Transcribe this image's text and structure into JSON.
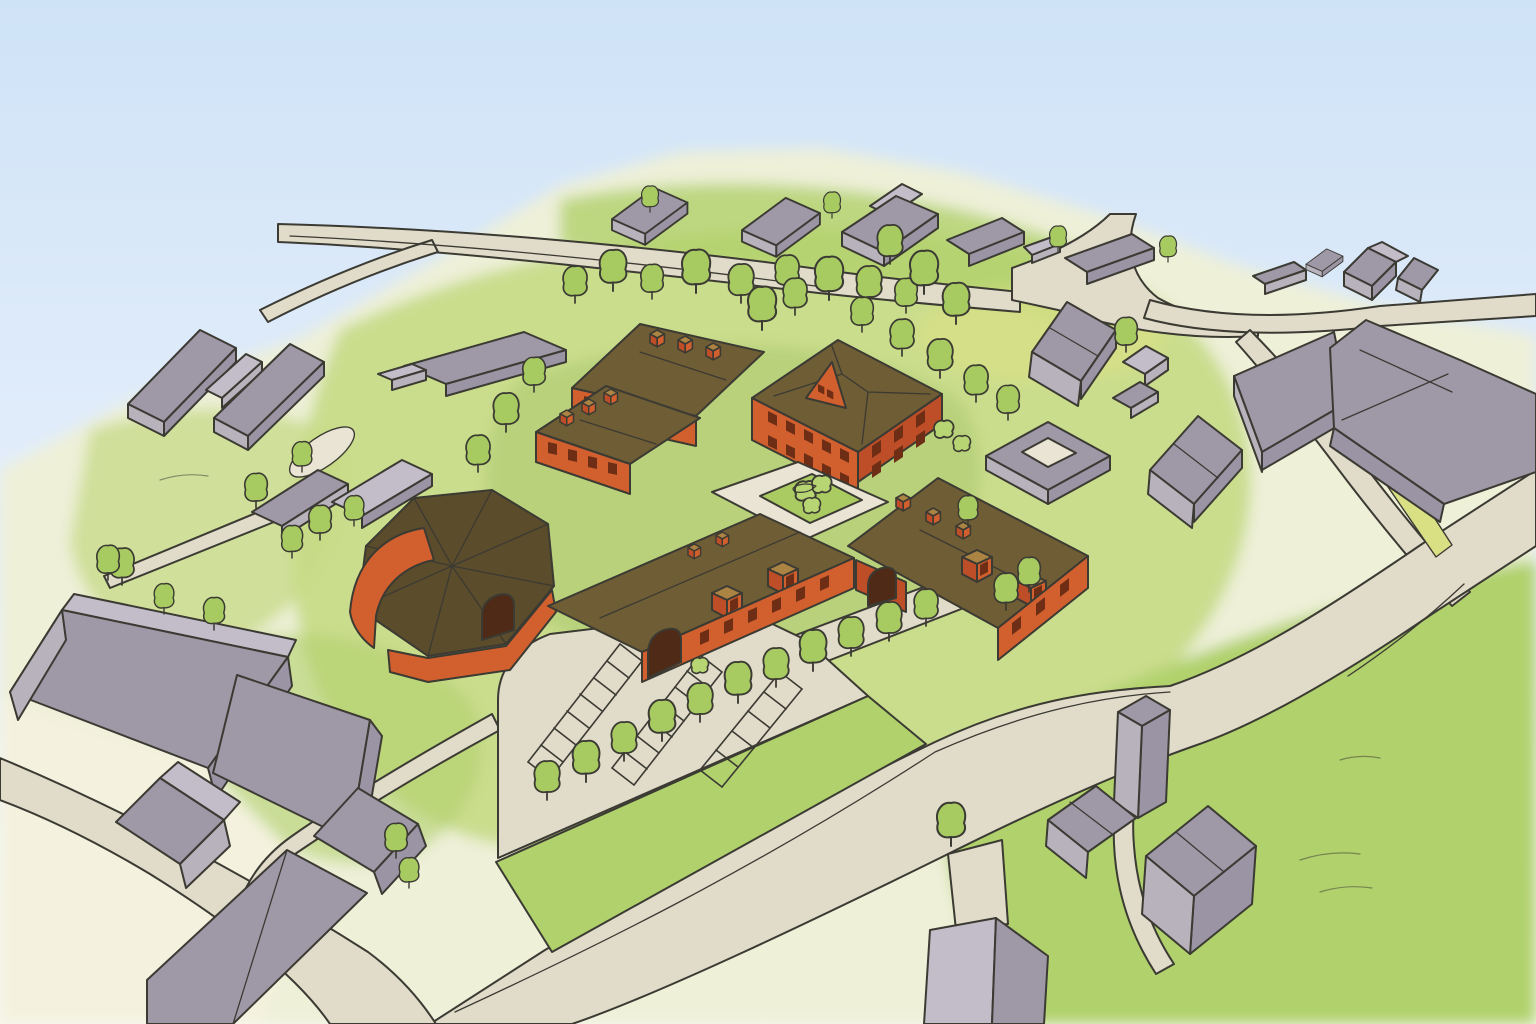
{
  "scene": {
    "type": "watercolor architectural aerial illustration",
    "description": "Hand-drawn watercolor bird's-eye view of a red-brick courtyard building complex with brown roofs, surrounded by a village of gray gabled buildings, tree-lined roads, green fields and a striped parking lot under a pale blue sky",
    "landmarks": {
      "main_complex": "Red-brick building complex around an inner courtyard",
      "manor_house": "Brick manor house with central pediment and two window rows",
      "barn": "Large barn wing with faceted roof and curved red gable",
      "courtyard": "Paved courtyard with a square green garden and bushes",
      "parking": "Parking lot with three striped bays and a tree-lined verge",
      "village_north": "Row of gray houses along the upper road",
      "farm_west": "Gray farm buildings with an oval path on the left",
      "industrial_southwest": "Long gray warehouse buildings in the lower left",
      "houses_southeast": "Cluster of gray houses at the end of a driveway"
    }
  },
  "palette": {
    "sky_top": "#cfe3f7",
    "sky_mid": "#e6effb",
    "horizon": "#f7f8f1",
    "ground_pale": "#eef0d8",
    "cream": "#f3f1de",
    "grass_soft": "#dfe9ae",
    "grass_mid": "#c5da85",
    "grass_bright": "#b0d16c",
    "grass_deep": "#8fb751",
    "verge_yellow": "#d9e084",
    "road": "#e1dcc9",
    "paving": "#e9e4d3",
    "stripe": "#f6f3e6",
    "outline": "#3b3a33",
    "brick": "#d2602e",
    "brick_dark": "#bd4e27",
    "brick_deep": "#a03d1f",
    "window": "#6e2d15",
    "arch": "#4f2a16",
    "roof": "#6f5d35",
    "roof_dark": "#5b4c2b",
    "tan": "#ab8342",
    "gray_wall": "#b8b2bc",
    "gray_wall_dark": "#9a94a4",
    "gray_roof": "#9e98a7",
    "gray_roof_light": "#c2bdc9",
    "tree": "#a7cb61",
    "bush": "#b8d573",
    "court_green": "#aacb62"
  }
}
